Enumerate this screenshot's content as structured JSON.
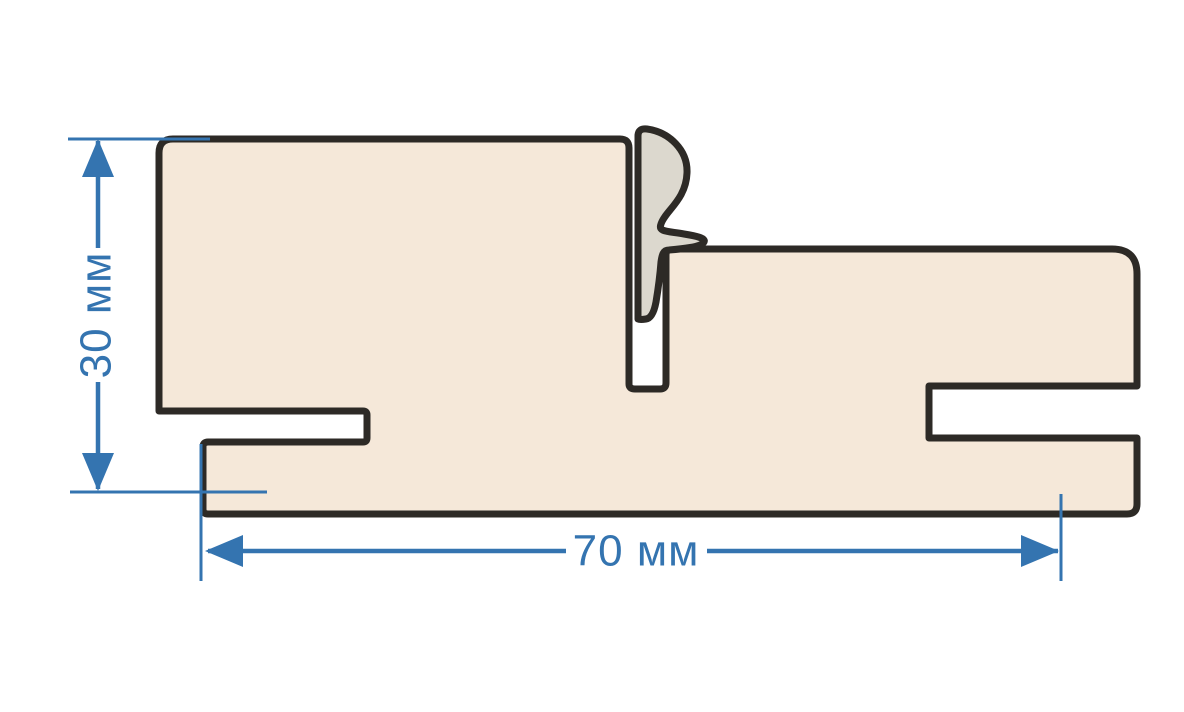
{
  "dimensions": {
    "height_label": "30 мм",
    "width_label": "70 мм"
  },
  "colors": {
    "dimension-blue": "#3474b0",
    "outline-dark": "#2d2a26",
    "profile-fill": "#f5e8d9",
    "seal-fill": "#dcd8ce",
    "background": "#ffffff"
  }
}
